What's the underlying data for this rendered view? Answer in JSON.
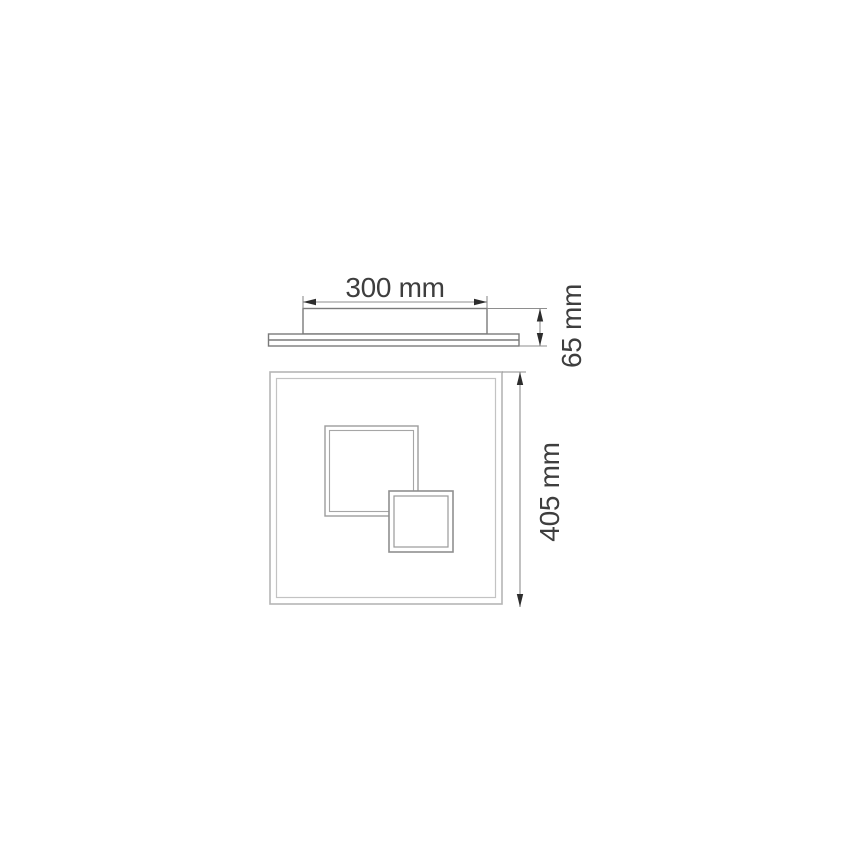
{
  "drawing": {
    "labels": {
      "canopy_width": "300 mm",
      "fixture_height": "65 mm",
      "panel_size": "405 mm"
    },
    "dimensions_mm": {
      "canopy_width": 300,
      "fixture_height": 65,
      "panel_size": 405
    },
    "colors": {
      "background": "#ffffff",
      "side_view_outline": "#7a7a7a",
      "panel_outline": "#b5b5b5",
      "inner_square_outline": "#9c9c9c",
      "small_square_outline": "#8f8f8f",
      "dimension_line": "#8e8e8e",
      "arrowhead": "#2d2d2d",
      "label_text": "#3e3e3e"
    }
  }
}
